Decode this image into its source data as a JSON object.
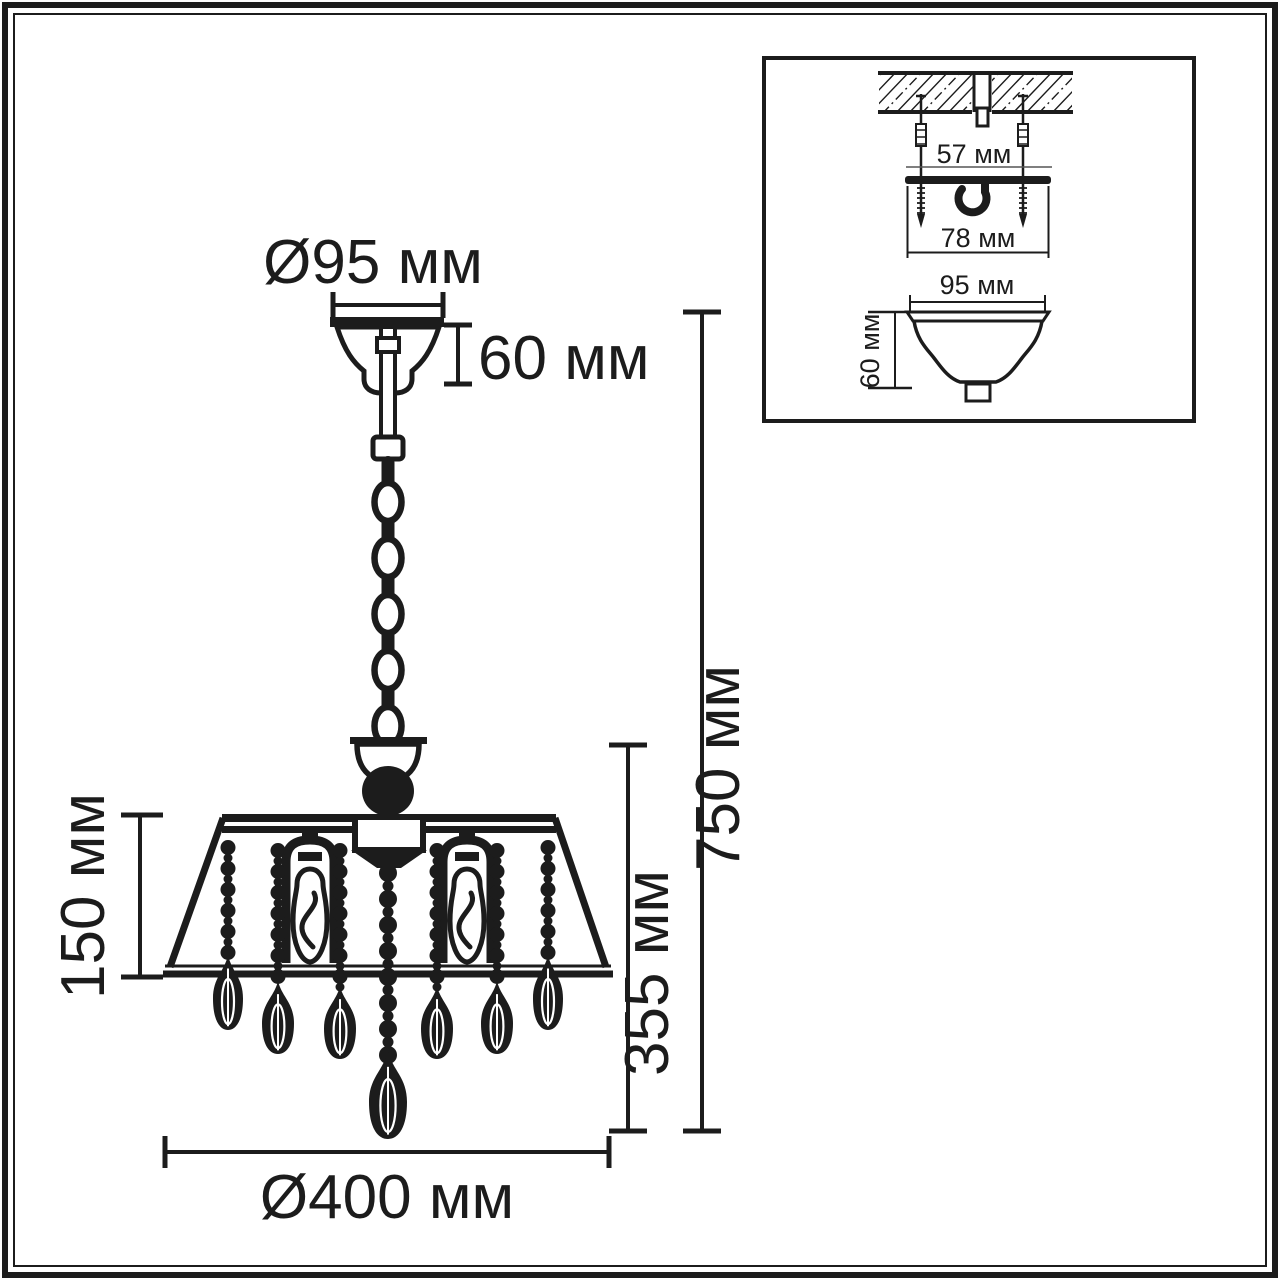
{
  "labels": {
    "main": {
      "canopy_diameter": "Ø95 мм",
      "canopy_height": "60 мм",
      "overall_height": "750 мм",
      "body_height": "355 мм",
      "shade_height": "150 мм",
      "body_diameter": "Ø400 мм"
    },
    "inset": {
      "anchor_spacing": "57 мм",
      "bracket_width": "78 мм",
      "canopy_diameter": "95 мм",
      "canopy_height": "60 мм"
    }
  },
  "colors": {
    "line": "#1c1c1c",
    "background": "#ffffff"
  }
}
